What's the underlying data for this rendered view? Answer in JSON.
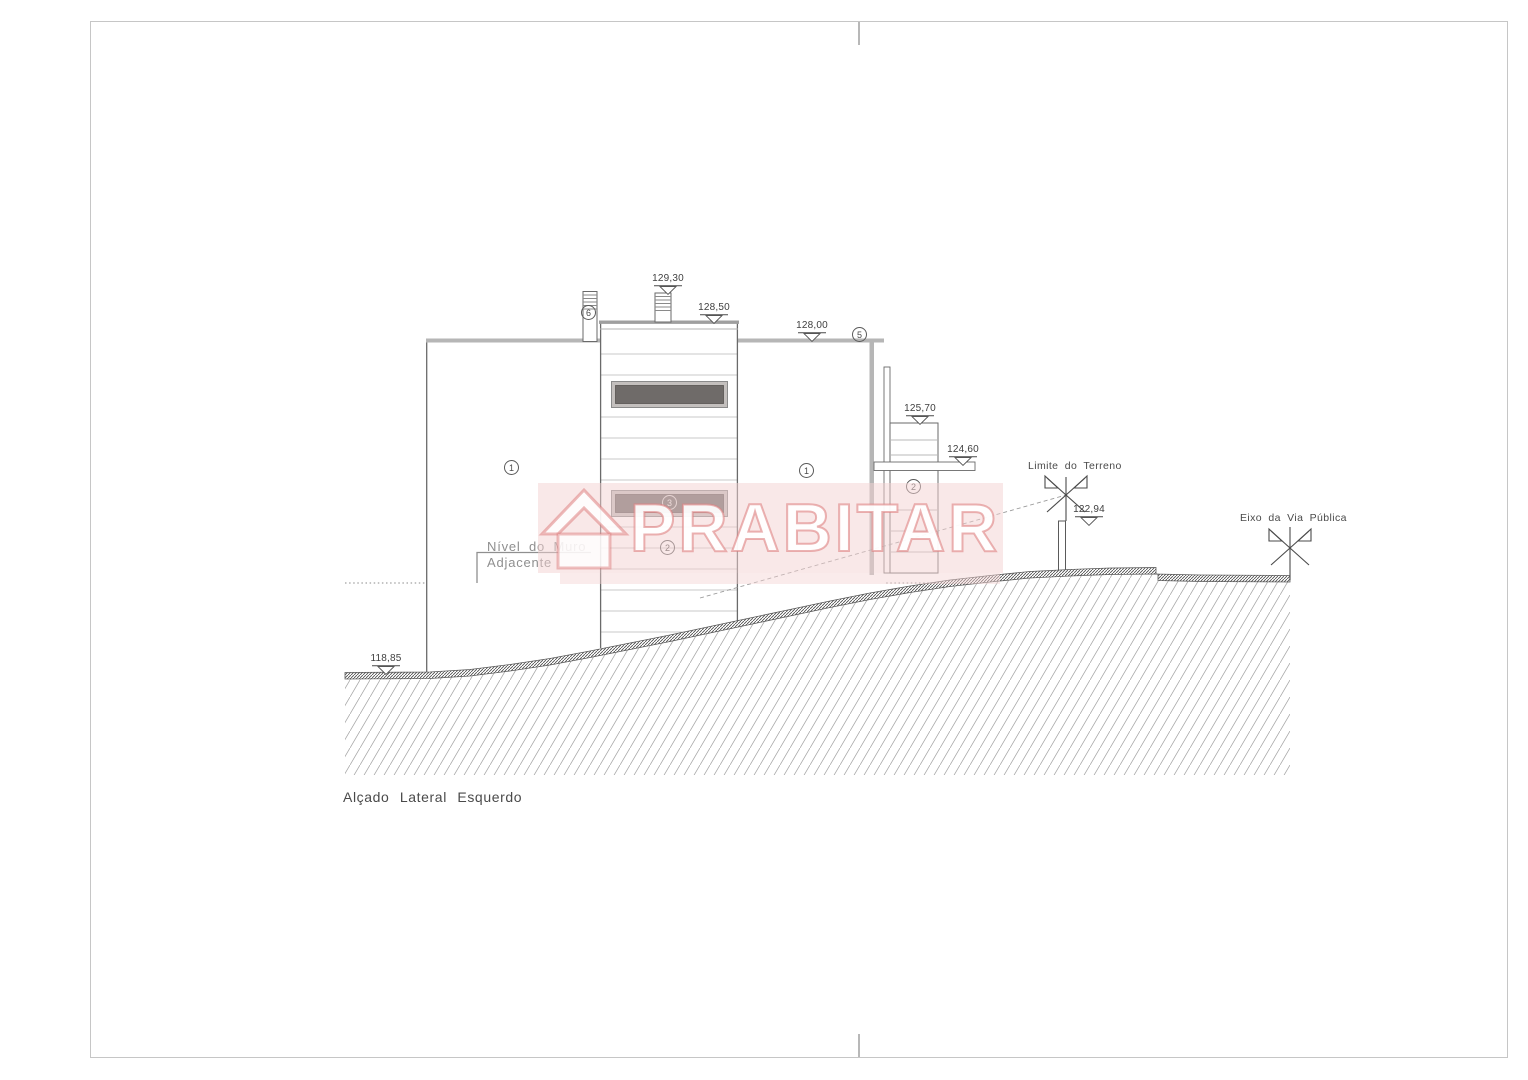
{
  "drawing": {
    "title": "Alçado Lateral Esquerdo"
  },
  "watermark": {
    "brand": "PRABITAR"
  },
  "annotations": {
    "nivel_muro_line1": "Nível do Muro",
    "nivel_muro_line2": "Adjacente",
    "limite_terreno": "Limite do Terreno",
    "eixo_via_publica": "Eixo da Via Pública"
  },
  "levels": [
    {
      "name": "chimney-top",
      "label": "129,30"
    },
    {
      "name": "tower-parapet",
      "label": "128,50"
    },
    {
      "name": "main-roof",
      "label": "128,00"
    },
    {
      "name": "annex-top",
      "label": "125,70"
    },
    {
      "name": "slab",
      "label": "124,60"
    },
    {
      "name": "terrain-limit",
      "label": "122,94"
    },
    {
      "name": "ground-left",
      "label": "118,85"
    }
  ],
  "callouts": [
    {
      "number": "1"
    },
    {
      "number": "1"
    },
    {
      "number": "2"
    },
    {
      "number": "3"
    },
    {
      "number": "2"
    },
    {
      "number": "5"
    },
    {
      "number": "6"
    }
  ],
  "colors": {
    "line": "#4a4a4a",
    "roof_gray": "#b6b6b6",
    "siding_gray": "#c9c9c9",
    "window_dark": "#6f6b69",
    "window_frame": "#c3bfbd",
    "watermark_pink": "#de8080"
  },
  "icons": {
    "level_arrow": "level-arrow-icon",
    "benchmark": "benchmark-x-icon",
    "house": "house-icon"
  }
}
